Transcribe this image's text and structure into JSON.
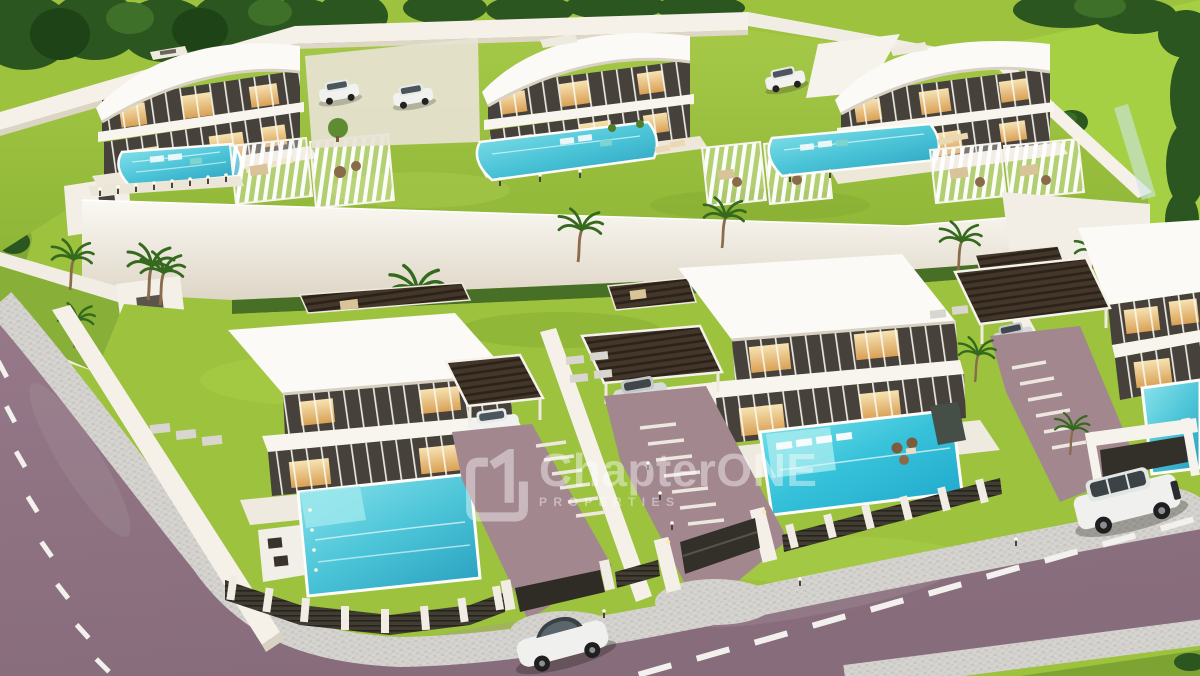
{
  "meta": {
    "title": "Aerial 3D architectural rendering of a gated luxury villa development"
  },
  "watermark": {
    "brand": "ChapterONE",
    "tagline": "PROPERTIES",
    "logo": "c1-monogram-icon"
  },
  "scene": {
    "upper_terrace": {
      "villas": [
        {
          "name": "curved-roof-villa-left",
          "features": [
            "two-storey glass facade",
            "lit interiors",
            "infinity pool",
            "sun loungers",
            "white slatted pergolas"
          ]
        },
        {
          "name": "curved-roof-villa-centre",
          "features": [
            "two-storey glass facade",
            "lit interiors",
            "infinity pool",
            "sun loungers"
          ]
        },
        {
          "name": "curved-roof-villa-right",
          "features": [
            "two-storey glass facade",
            "lit interiors",
            "infinity pool",
            "carport with white car",
            "white slatted pergolas"
          ]
        }
      ],
      "details": [
        "white perimeter walls",
        "mature trees behind rear wall",
        "parked white cars in courtyard",
        "bollard path lights",
        "tall white retaining wall with palm trees"
      ]
    },
    "lower_row": {
      "villas": [
        {
          "name": "flat-roof-villa-left",
          "features": [
            "pool with entry steps",
            "outdoor kitchen",
            "dark slatted carport with white car",
            "gated driveway",
            "stepping-stone path"
          ]
        },
        {
          "name": "flat-roof-villa-centre",
          "features": [
            "pool with in-water loungers",
            "water-feature wall",
            "dark slatted carport with silver SUV",
            "gated driveway",
            "slatted pergola lounge"
          ]
        },
        {
          "name": "flat-roof-villa-right",
          "features": [
            "corner pool",
            "dark slatted carport with silver car",
            "portal-frame gate",
            "palm trees"
          ]
        }
      ],
      "details": [
        "white boundary walls",
        "dark slatted fences with white piers",
        "cobbled gate aprons",
        "bollard lights"
      ]
    },
    "streets": {
      "roads": [
        "left perimeter road",
        "main front road"
      ],
      "markings": "white dashed centre lines",
      "sidewalk": "grey cobblestone border",
      "vehicles": [
        "white SUV on main road",
        "white coupe at bottom edge"
      ]
    },
    "palette": {
      "grass": "#9cc23e",
      "grass_bright": "#aed24a",
      "grass_shadow": "#7da432",
      "foliage_dark": "#2b5620",
      "wall_white": "#f5f1e9",
      "wall_shade": "#dcd4c4",
      "glass_dark": "#46413a",
      "warm_light": "#f2cf93",
      "pool_water": "#4cc5d8",
      "pool_deep": "#2da4c2",
      "road_asphalt": "#8e7180",
      "road_marking": "#f2f1ed",
      "sidewalk_grey": "#d4d2ce",
      "slat_brown": "#43362a",
      "fence_dark": "#3c382f",
      "driveway_mauve": "#a2878f",
      "car_white": "#f0f1ef",
      "car_silver": "#d6d8d9"
    }
  }
}
